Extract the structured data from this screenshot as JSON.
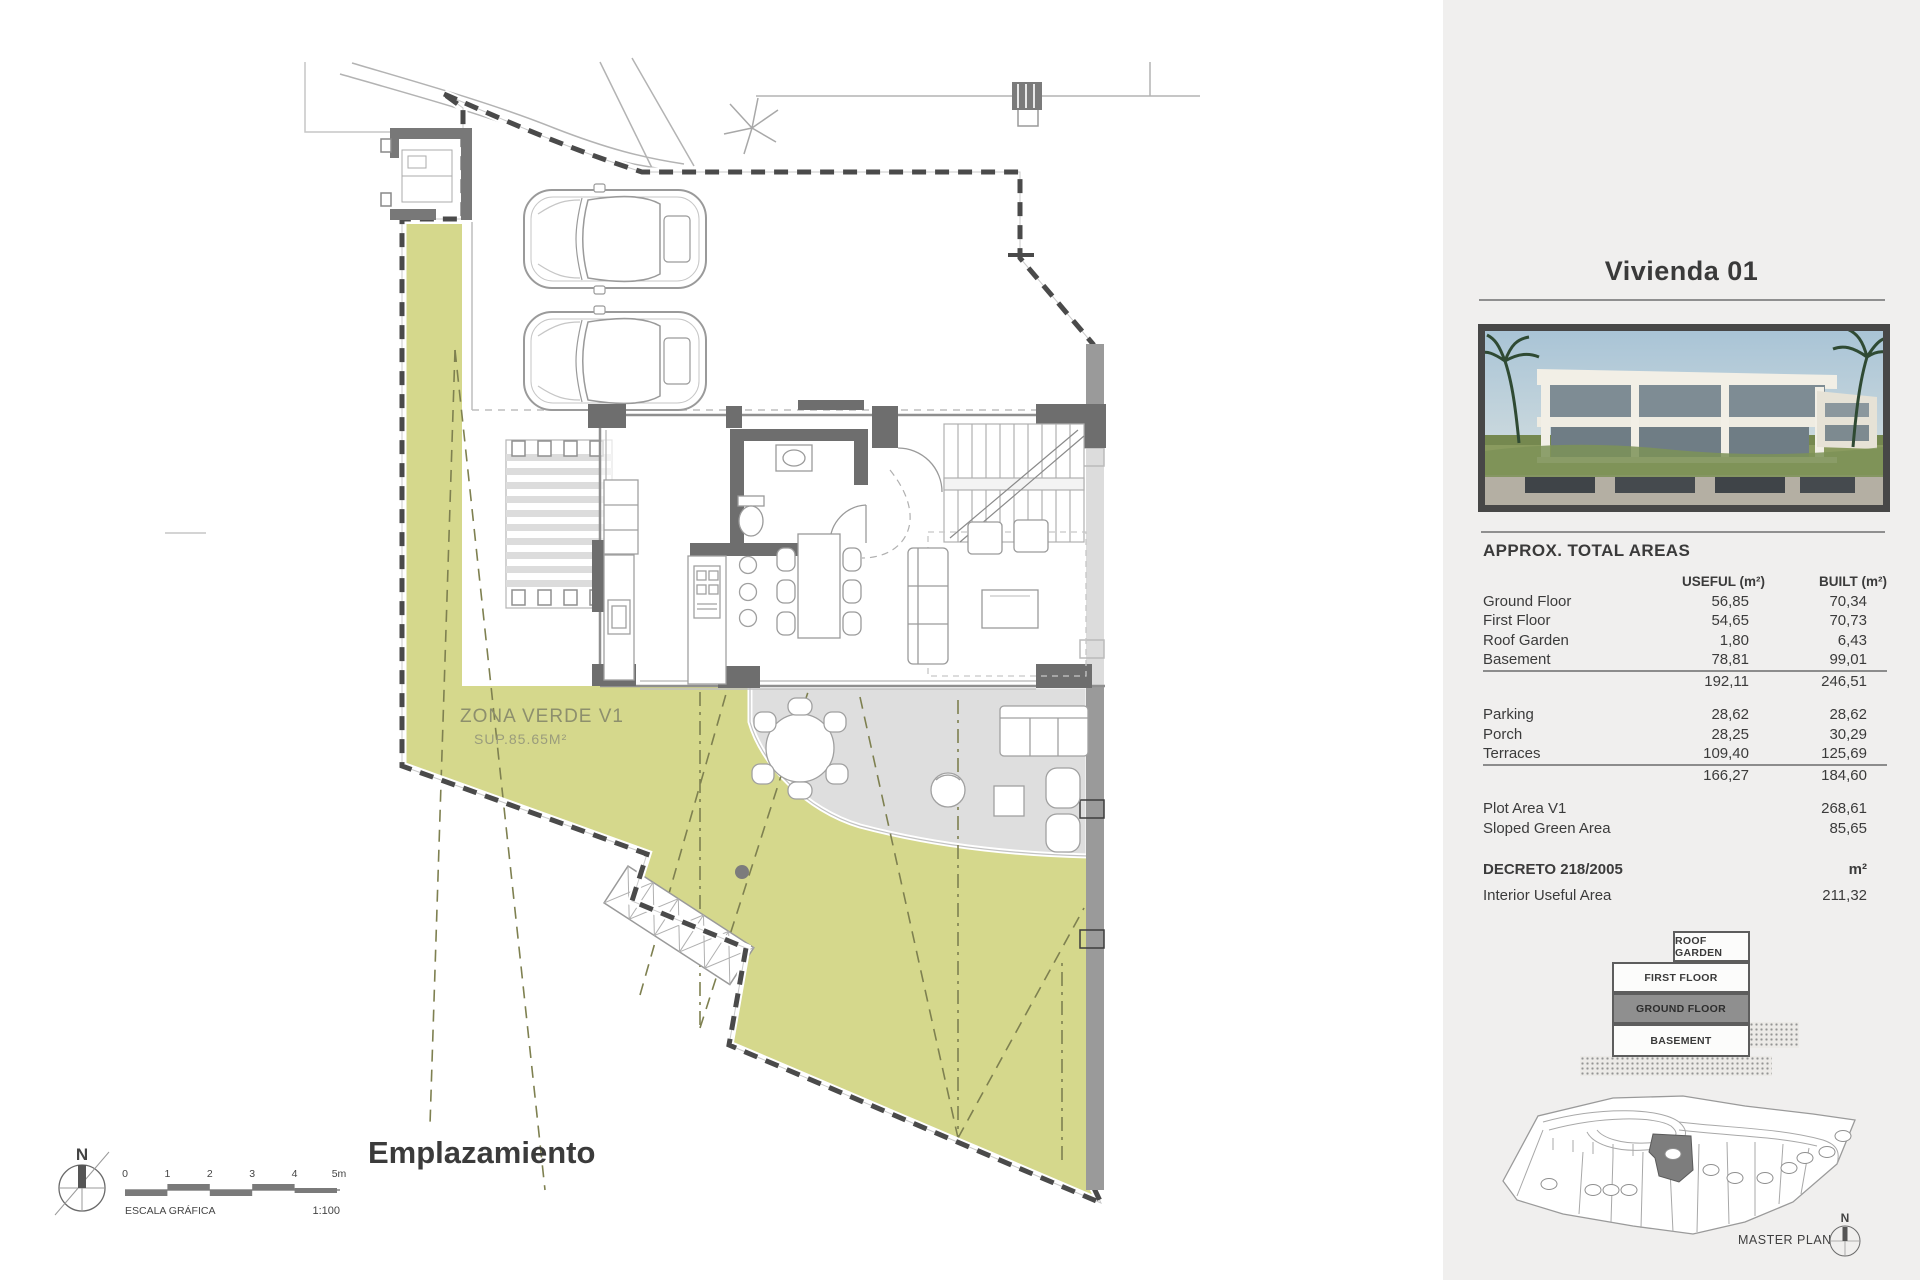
{
  "plan": {
    "zona_verde": {
      "title": "ZONA VERDE V1",
      "sub": "SUP.85.65M²"
    },
    "caption": "Emplazamiento",
    "north": "N",
    "scale": {
      "ticks": [
        "0",
        "1",
        "2",
        "3",
        "4",
        "5m"
      ],
      "label": "ESCALA GRÁFICA",
      "ratio": "1:100"
    }
  },
  "panel": {
    "title": "Vivienda 01",
    "areas": {
      "heading": "APPROX. TOTAL AREAS",
      "columns": {
        "useful": "USEFUL (m²)",
        "built": "BUILT (m²)"
      },
      "floors": [
        {
          "label": "Ground Floor",
          "useful": "56,85",
          "built": "70,34"
        },
        {
          "label": "First Floor",
          "useful": "54,65",
          "built": "70,73"
        },
        {
          "label": "Roof Garden",
          "useful": "1,80",
          "built": "6,43"
        },
        {
          "label": "Basement",
          "useful": "78,81",
          "built": "99,01"
        }
      ],
      "floors_total": {
        "useful": "192,11",
        "built": "246,51"
      },
      "exterior": [
        {
          "label": "Parking",
          "useful": "28,62",
          "built": "28,62"
        },
        {
          "label": "Porch",
          "useful": "28,25",
          "built": "30,29"
        },
        {
          "label": "Terraces",
          "useful": "109,40",
          "built": "125,69"
        }
      ],
      "exterior_total": {
        "useful": "166,27",
        "built": "184,60"
      },
      "plot": [
        {
          "label": "Plot Area V1",
          "value": "268,61"
        },
        {
          "label": "Sloped Green Area",
          "value": "85,65"
        }
      ]
    },
    "decreto": {
      "heading": "DECRETO 218/2005",
      "unit": "m²",
      "row": {
        "label": "Interior Useful Area",
        "value": "211,32"
      }
    },
    "stack": {
      "roof": "ROOF GARDEN",
      "first": "FIRST FLOOR",
      "ground": "GROUND FLOOR",
      "basement": "BASEMENT"
    },
    "master_plan": {
      "label": "MASTER PLAN",
      "north": "N"
    },
    "colors": {
      "green_area": "#d5d88c",
      "terrace_gray": "#dedede",
      "wall_dark": "#6e6e6e",
      "boundary": "#4a4a4a",
      "panel_bg": "#f0efee"
    }
  }
}
